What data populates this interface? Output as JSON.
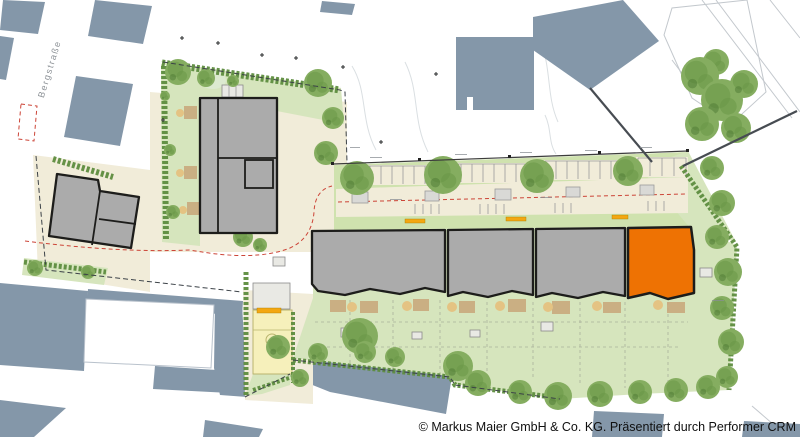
{
  "plan": {
    "street_label": "Bergstraße",
    "copyright": "© Markus Maier GmbH & Co. KG. Präsentiert durch Performer CRM"
  },
  "colors": {
    "existing": "#8497a9",
    "building": "#ababab",
    "outline": "#1d1d1b",
    "highlight": "#ee7203",
    "paving": "#f1ecd9",
    "green": "#d6e5bd",
    "green2": "#cfe2ae",
    "hedge": "#5d8c3e",
    "tree": "#85ad60",
    "treedark": "#6a9747",
    "terrace": "#c9a87c",
    "tan": "#e4c383",
    "playground": "#f6f0bb",
    "bar": "#f3a712",
    "red": "#cc4437",
    "faint": "#c3c8cd"
  }
}
